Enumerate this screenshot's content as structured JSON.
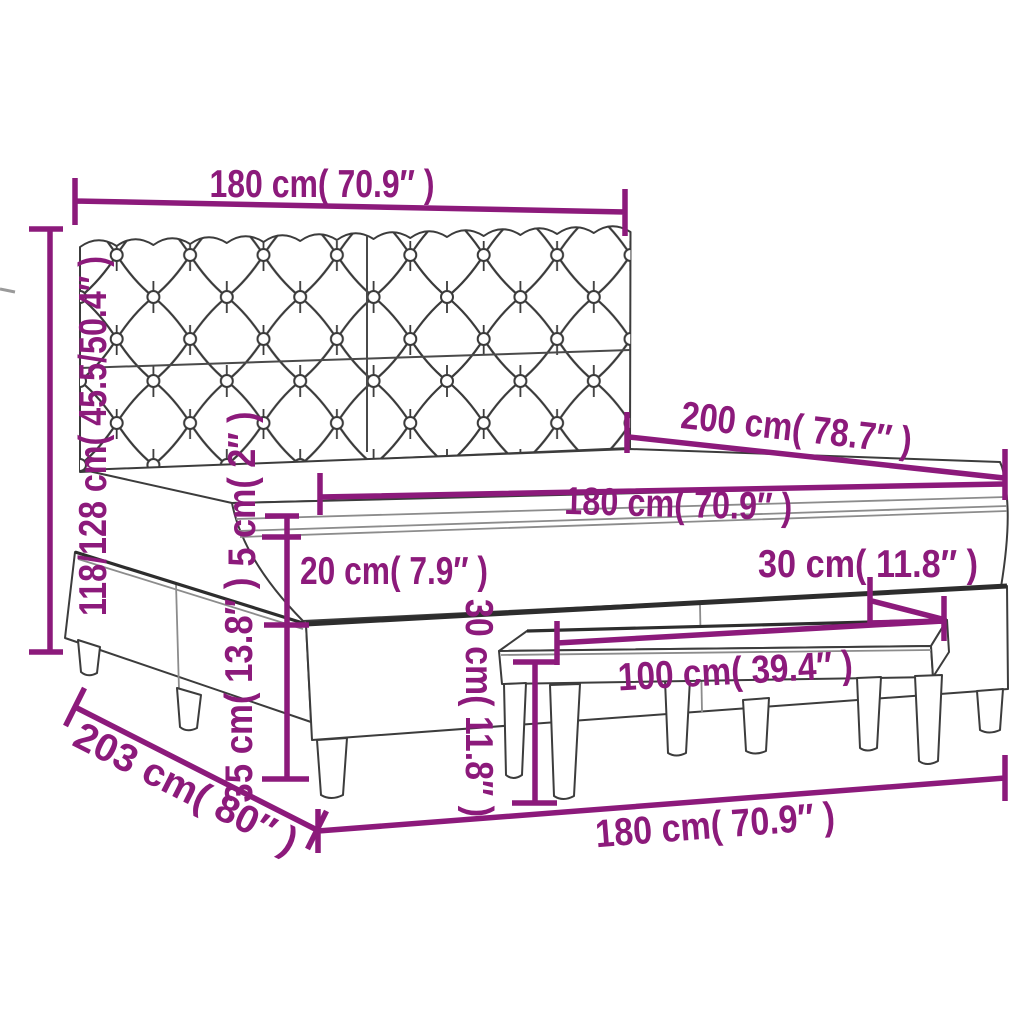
{
  "diagram": {
    "title": "Box spring bed with tufted headboard, mattress topper and bench - dimension drawing",
    "colors": {
      "dimension_accent": "#8C1A7B",
      "outline": "#3C3C3C",
      "outline_dark": "#2D2D2D",
      "outline_light": "#8C8C8C",
      "background": "#FFFFFF"
    },
    "dimensions": [
      {
        "id": "headboard-width",
        "label": "180 cm( 70.9″ )"
      },
      {
        "id": "headboard-height",
        "label": "118/128 cm( 45.5/50.4″ )"
      },
      {
        "id": "bed-length",
        "label": "200 cm( 78.7″ )"
      },
      {
        "id": "mattress-width",
        "label": "180 cm( 70.9″ )"
      },
      {
        "id": "topper-thickness",
        "label": "5 cm( 2″ )"
      },
      {
        "id": "frame-height",
        "label": "20 cm( 7.9″ )"
      },
      {
        "id": "bench-seat-depth",
        "label": "30 cm( 11.8″ )"
      },
      {
        "id": "bench-length",
        "label": "100 cm( 39.4″ )"
      },
      {
        "id": "leg-height",
        "label": "35 cm( 13.8″ )"
      },
      {
        "id": "bench-height",
        "label": "30 cm( 11.8″ )"
      },
      {
        "id": "bed-base-length",
        "label": "203 cm( 80″ )"
      },
      {
        "id": "bed-width",
        "label": "180 cm( 70.9″ )"
      }
    ]
  }
}
